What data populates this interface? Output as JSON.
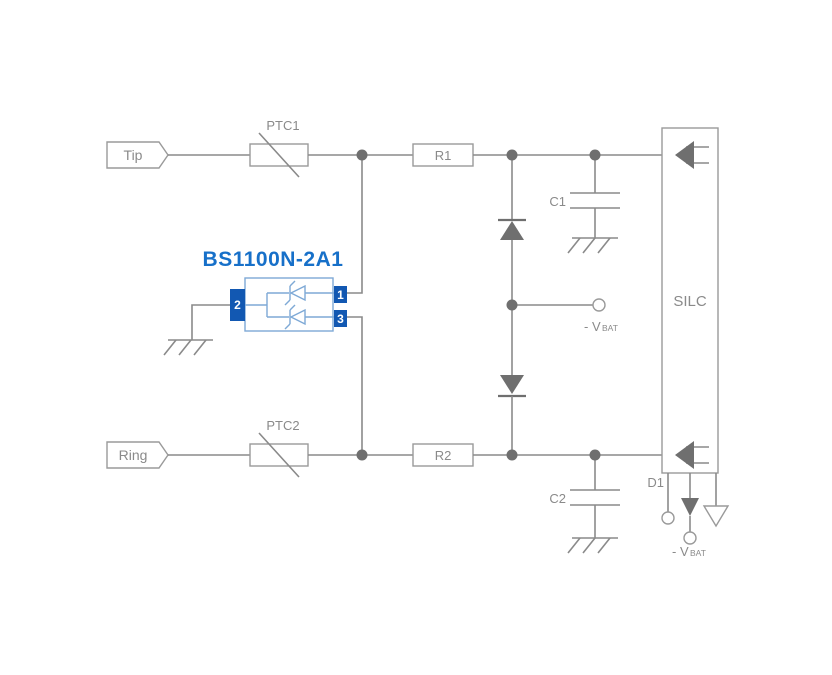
{
  "diagram": {
    "type": "circuit-schematic",
    "title": "BS1100N-2A1",
    "labels": {
      "tip": "Tip",
      "ring": "Ring",
      "ptc1": "PTC1",
      "ptc2": "PTC2",
      "r1": "R1",
      "r2": "R2",
      "c1": "C1",
      "c2": "C2",
      "d1": "D1",
      "silc": "SILC",
      "vbat_prefix": "- V",
      "vbat_sub": "BAT"
    },
    "component": {
      "name": "BS1100N-2A1",
      "pins": [
        "1",
        "2",
        "3"
      ]
    },
    "colors": {
      "wire_gray": "#8a8a8a",
      "dark_gray": "#6f6f6f",
      "outline_gray": "#9a9a9a",
      "label_gray": "#8a8a8a",
      "title_blue": "#1770c9",
      "pin_blue": "#1258b2",
      "symbol_light_blue": "#7ea9d6",
      "background": "#ffffff"
    }
  }
}
